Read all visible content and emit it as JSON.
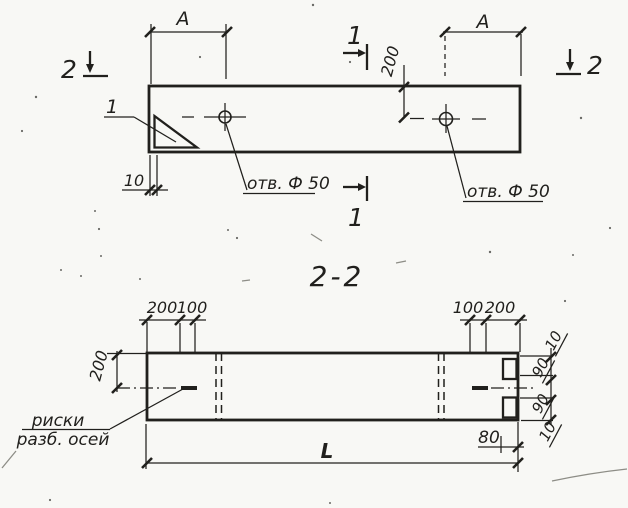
{
  "colors": {
    "paper": "#f8f8f5",
    "ink": "#21201d"
  },
  "top_view": {
    "section_cut_left": "2",
    "section_cut_right": "2",
    "section_cut_top": "1",
    "section_cut_bottom": "1",
    "corner_detail_callout": "1",
    "dim_span_left": "А",
    "dim_span_right": "А",
    "dim_edge_to_hole_axis": "200",
    "dim_end_offset": "10",
    "hole_label_left": "отв. Ф 50",
    "hole_label_right": "отв. Ф 50"
  },
  "section_view": {
    "title": "2-2",
    "dim_top_left_outer": "200",
    "dim_top_left_inner": "100",
    "dim_top_right_inner": "100",
    "dim_top_right_outer": "200",
    "dim_height_to_axis": "200",
    "dim_right_chain": [
      "10",
      "90",
      "90",
      "10"
    ],
    "dim_notch": "80",
    "dim_length": "L",
    "axis_marks_label_line1": "риски",
    "axis_marks_label_line2": "разб. осей"
  }
}
